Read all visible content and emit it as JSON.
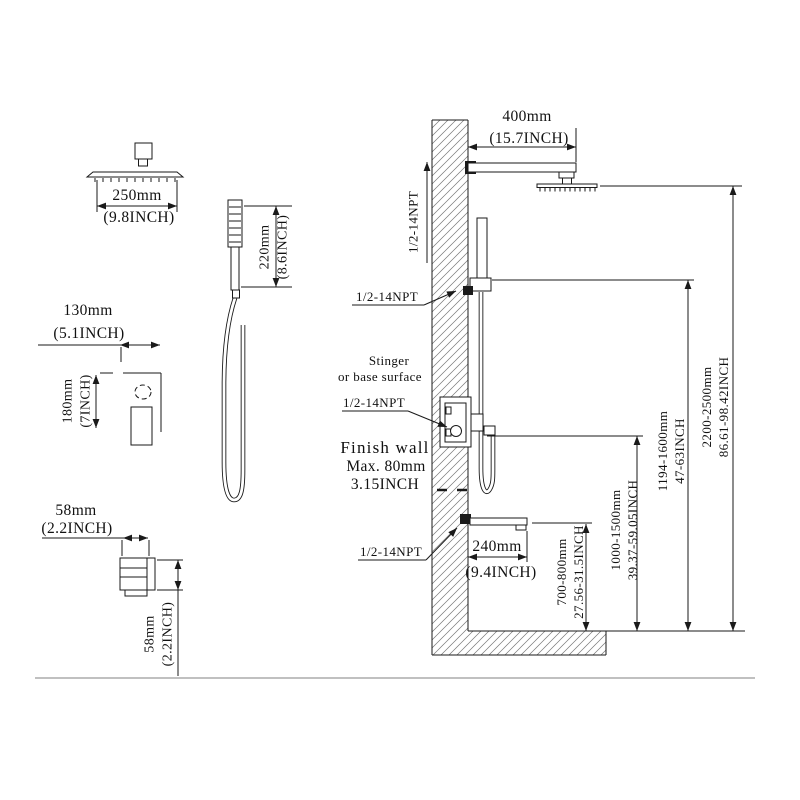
{
  "drawing": {
    "colors": {
      "line": "#1a1a1a",
      "text": "#111111",
      "baseline": "#9a9a9a"
    },
    "shower_head": {
      "width_mm": "250mm",
      "width_in": "(9.8INCH)"
    },
    "hand_shower": {
      "height_mm": "220mm",
      "height_in": "(8.6INCH)"
    },
    "valve": {
      "width_mm": "130mm",
      "width_in": "(5.1INCH)",
      "height_mm": "180mm",
      "height_in": "(7INCH)"
    },
    "spout": {
      "width_mm": "58mm",
      "width_in": "(2.2INCH)",
      "height_mm": "58mm",
      "height_in": "(2.2INCH)"
    },
    "install": {
      "npt": "1/2-14NPT",
      "arm_mm": "400mm",
      "arm_in": "(15.7INCH)",
      "surface_note_1": "Stinger",
      "surface_note_2": "or base surface",
      "finish_wall_1": "Finish wall",
      "finish_wall_2": "Max. 80mm",
      "finish_wall_3": "3.15INCH",
      "spout_mm": "240mm",
      "spout_in": "(9.4INCH)",
      "heights": [
        {
          "mm": "700-800mm",
          "inch": "27.56-31.5INCH"
        },
        {
          "mm": "1000-1500mm",
          "inch": "39.37-59.05INCH"
        },
        {
          "mm": "1194-1600mm",
          "inch": "47-63INCH"
        },
        {
          "mm": "2200-2500mm",
          "inch": "86.61-98.42INCH"
        }
      ]
    }
  }
}
